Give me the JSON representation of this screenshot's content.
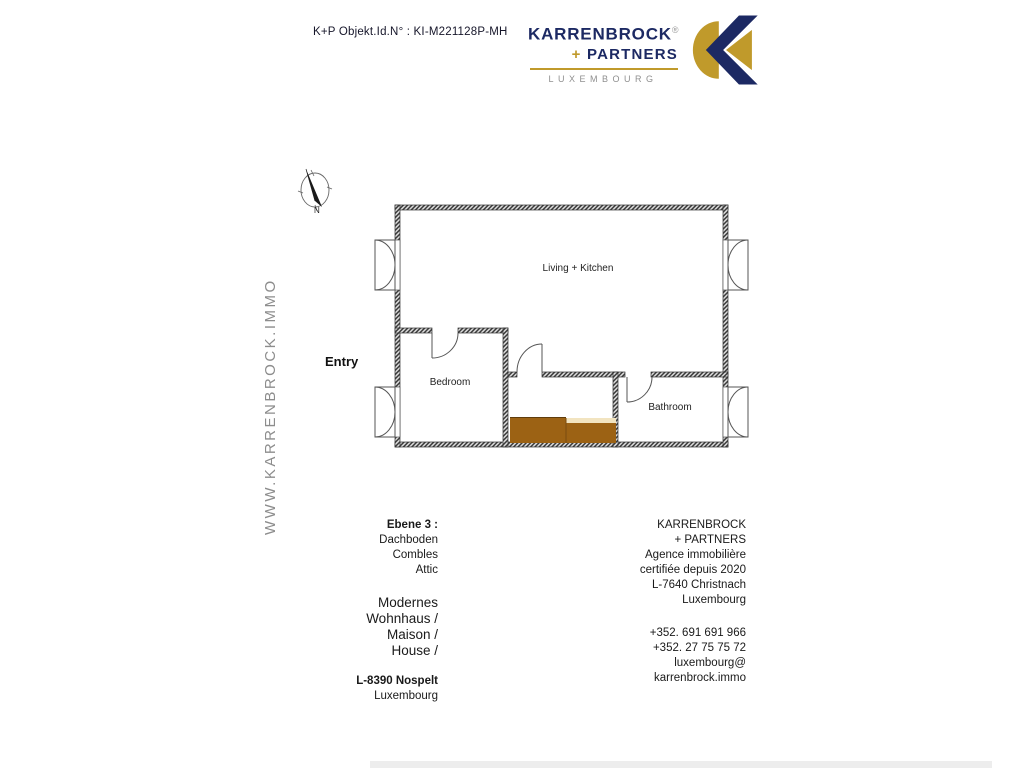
{
  "header": {
    "object_id": "K+P Objekt.Id.N° : KI-M221128P-MH"
  },
  "brand": {
    "name": "KARRENBROCK",
    "registered": "®",
    "plus": "+",
    "partners": "PARTNERS",
    "country": "LUXEMBOURG"
  },
  "watermark": "WWW.KARRENBROCK.IMMO",
  "floorplan": {
    "compass_label": "N",
    "entry_label": "Entry",
    "rooms": [
      {
        "name": "Living + Kitchen"
      },
      {
        "name": "Bedroom"
      },
      {
        "name": "Bathroom"
      }
    ]
  },
  "info_left": {
    "level_label": "Ebene 3 :",
    "level_lines": [
      "Dachboden",
      "Combles",
      "Attic"
    ],
    "type_lines": [
      "Modernes",
      "Wohnhaus /",
      "Maison /",
      "House /"
    ],
    "address_bold": "L-8390 Nospelt",
    "address_city": "Luxembourg"
  },
  "info_right": {
    "agency_lines": [
      "KARRENBROCK",
      "+ PARTNERS",
      "Agence immobilière",
      "certifiée depuis 2020",
      "L-7640 Christnach",
      "Luxembourg"
    ],
    "phone_lines": [
      "+352. 691 691 966",
      "+352. 27 75 75 72"
    ],
    "email_lines": [
      "luxembourg@",
      "karrenbrock.immo"
    ]
  },
  "colors": {
    "brand_navy": "#1c2963",
    "brand_gold": "#c09a2b",
    "stair_brown": "#9c6214",
    "stair_cream": "#f2e4c0",
    "watermark_gray": "#8d8d8d"
  }
}
